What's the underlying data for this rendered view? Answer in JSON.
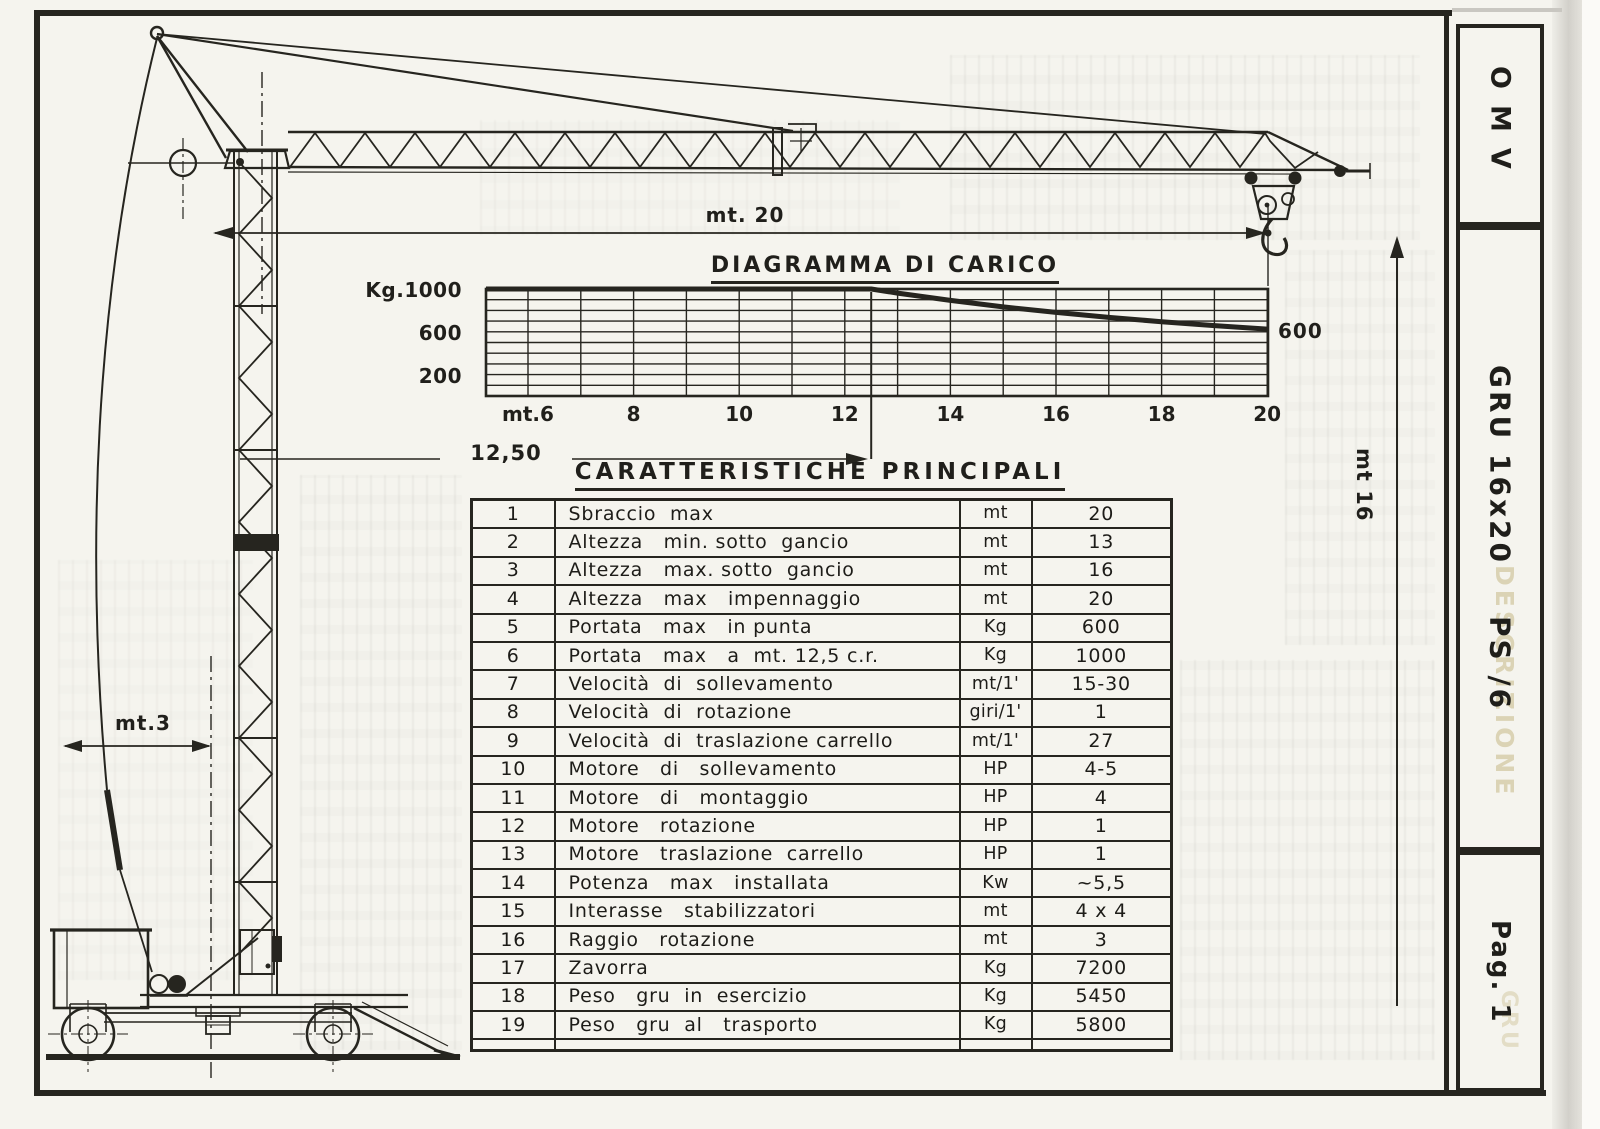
{
  "sidebar": {
    "brand": "OMV",
    "model_line": "GRU 16x20    PS /6",
    "page_label": "Pag. 1",
    "ghost_word": "DESCRIZIONE",
    "ghost_word_2": "GRU"
  },
  "drawing_labels": {
    "jib_length": "mt. 20",
    "hook_height": "mt 16",
    "tail_radius": "mt.3"
  },
  "chart_data": {
    "type": "line",
    "title": "DIAGRAMMA DI CARICO",
    "xlabel": "mt",
    "ylabel": "Kg",
    "xlim": [
      6,
      20
    ],
    "ylim": [
      0,
      1000
    ],
    "x_grid_step": 1,
    "y_grid_step": 100,
    "grid": true,
    "x_ticks": [
      {
        "v": 6,
        "label": "mt.6"
      },
      {
        "v": 8,
        "label": "8"
      },
      {
        "v": 10,
        "label": "10"
      },
      {
        "v": 12,
        "label": "12"
      },
      {
        "v": 14,
        "label": "14"
      },
      {
        "v": 16,
        "label": "16"
      },
      {
        "v": 18,
        "label": "18"
      },
      {
        "v": 20,
        "label": "20"
      }
    ],
    "y_ticks": [
      {
        "v": 1000,
        "prefix": "Kg.",
        "label": "1000"
      },
      {
        "v": 600,
        "label": "600"
      },
      {
        "v": 200,
        "label": "200"
      }
    ],
    "series": [
      {
        "name": "portata (Kg) vs sbraccio (mt)",
        "points": [
          [
            6,
            1000
          ],
          [
            12.5,
            1000
          ],
          [
            13,
            962
          ],
          [
            14,
            893
          ],
          [
            15,
            833
          ],
          [
            16,
            781
          ],
          [
            17,
            735
          ],
          [
            18,
            694
          ],
          [
            19,
            658
          ],
          [
            20,
            625
          ]
        ]
      }
    ],
    "annotations": [
      {
        "text": "600",
        "type": "end-label",
        "x": 20,
        "y": 625
      },
      {
        "text": "12,50",
        "type": "radius-marker",
        "x": 12.5
      }
    ]
  },
  "table": {
    "title": "CARATTERISTICHE PRINCIPALI",
    "rows": [
      [
        "1",
        "Sbraccio  max",
        "mt",
        "20"
      ],
      [
        "2",
        "Altezza   min. sotto  gancio",
        "mt",
        "13"
      ],
      [
        "3",
        "Altezza   max. sotto  gancio",
        "mt",
        "16"
      ],
      [
        "4",
        "Altezza   max   impennaggio",
        "mt",
        "20"
      ],
      [
        "5",
        "Portata   max   in punta",
        "Kg",
        "600"
      ],
      [
        "6",
        "Portata   max   a  mt. 12,5 c.r.",
        "Kg",
        "1000"
      ],
      [
        "7",
        "Velocità  di  sollevamento",
        "mt/1'",
        "15-30"
      ],
      [
        "8",
        "Velocità  di  rotazione",
        "giri/1'",
        "1"
      ],
      [
        "9",
        "Velocità  di  traslazione carrello",
        "mt/1'",
        "27"
      ],
      [
        "10",
        "Motore   di   sollevamento",
        "HP",
        "4-5"
      ],
      [
        "11",
        "Motore   di   montaggio",
        "HP",
        "4"
      ],
      [
        "12",
        "Motore   rotazione",
        "HP",
        "1"
      ],
      [
        "13",
        "Motore   traslazione  carrello",
        "HP",
        "1"
      ],
      [
        "14",
        "Potenza   max   installata",
        "Kw",
        "~5,5"
      ],
      [
        "15",
        "Interasse   stabilizzatori",
        "mt",
        "4 x 4"
      ],
      [
        "16",
        "Raggio   rotazione",
        "mt",
        "3"
      ],
      [
        "17",
        "Zavorra",
        "Kg",
        "7200"
      ],
      [
        "18",
        "Peso   gru  in  esercizio",
        "Kg",
        "5450"
      ],
      [
        "19",
        "Peso   gru  al   trasporto",
        "Kg",
        "5800"
      ]
    ]
  }
}
